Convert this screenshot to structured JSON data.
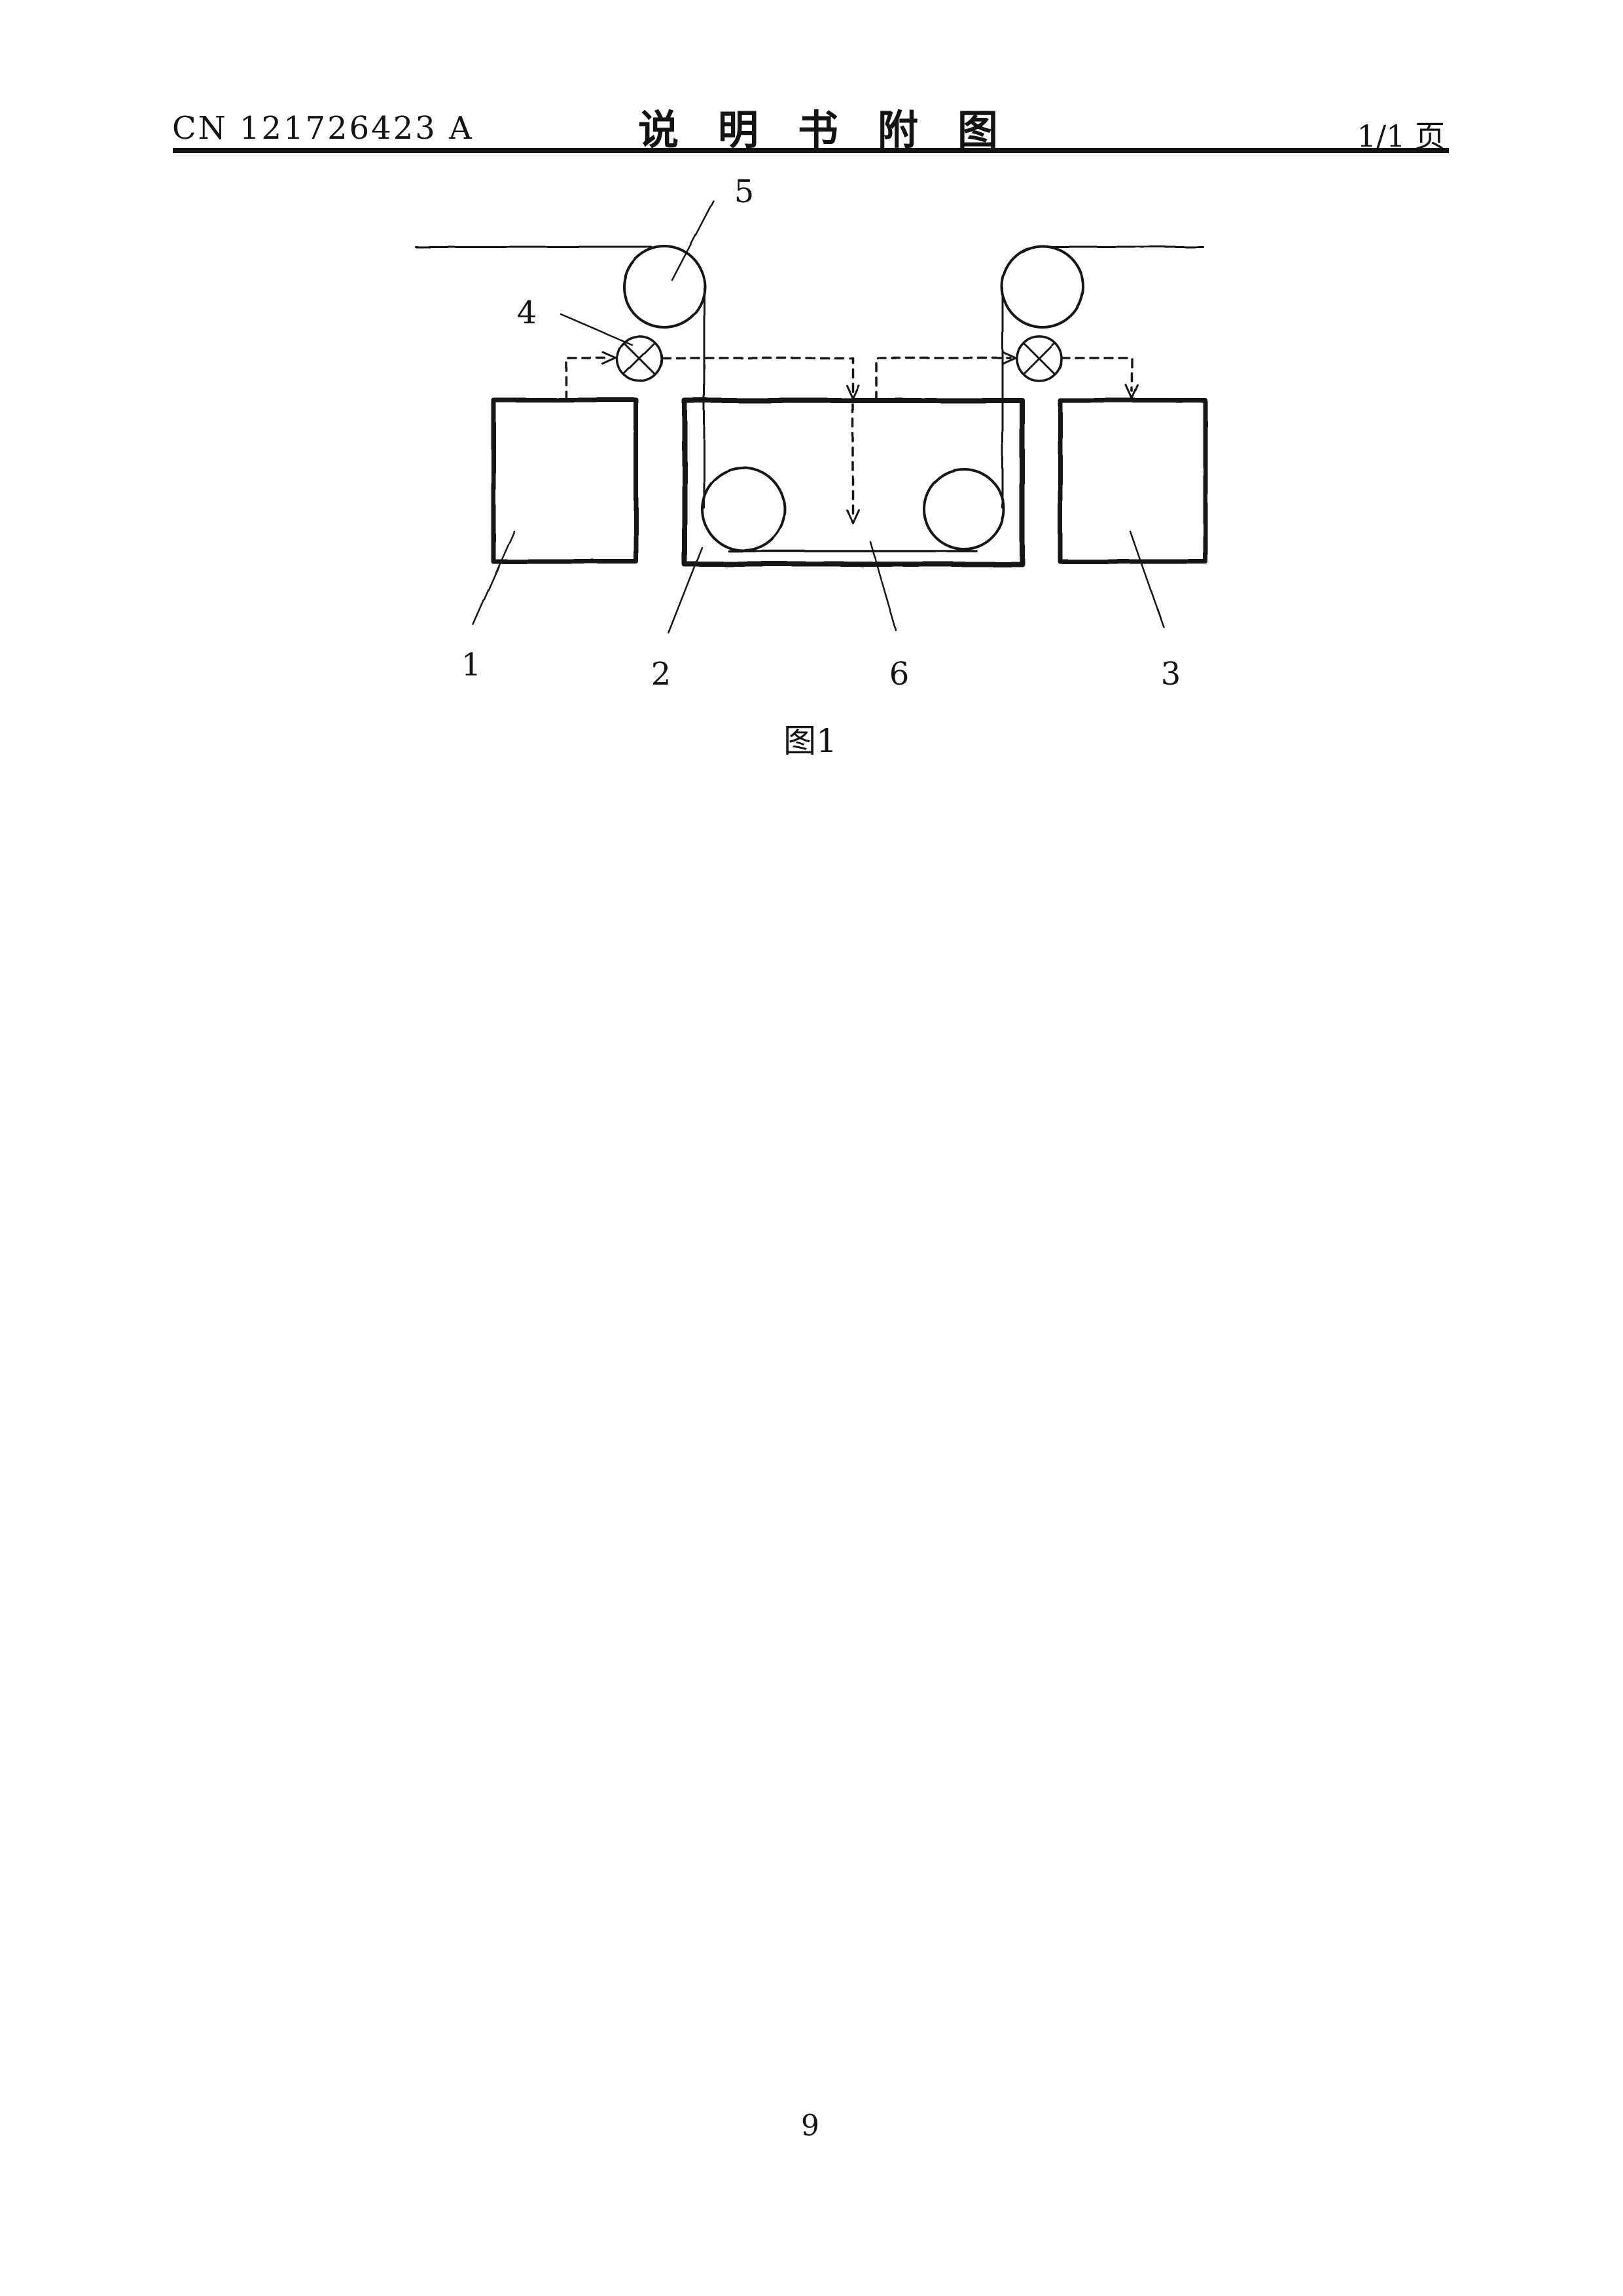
{
  "header": {
    "doc_number": "CN 121726423 A",
    "title": "说明书附图",
    "page_indicator": "1/1 页"
  },
  "figure": {
    "caption": "图1",
    "labels": {
      "1": "1",
      "2": "2",
      "3": "3",
      "4": "4",
      "5": "5",
      "6": "6"
    }
  },
  "footer": {
    "page_number": "9"
  },
  "ink_color": "#141414",
  "paper_color": "#ffffff"
}
